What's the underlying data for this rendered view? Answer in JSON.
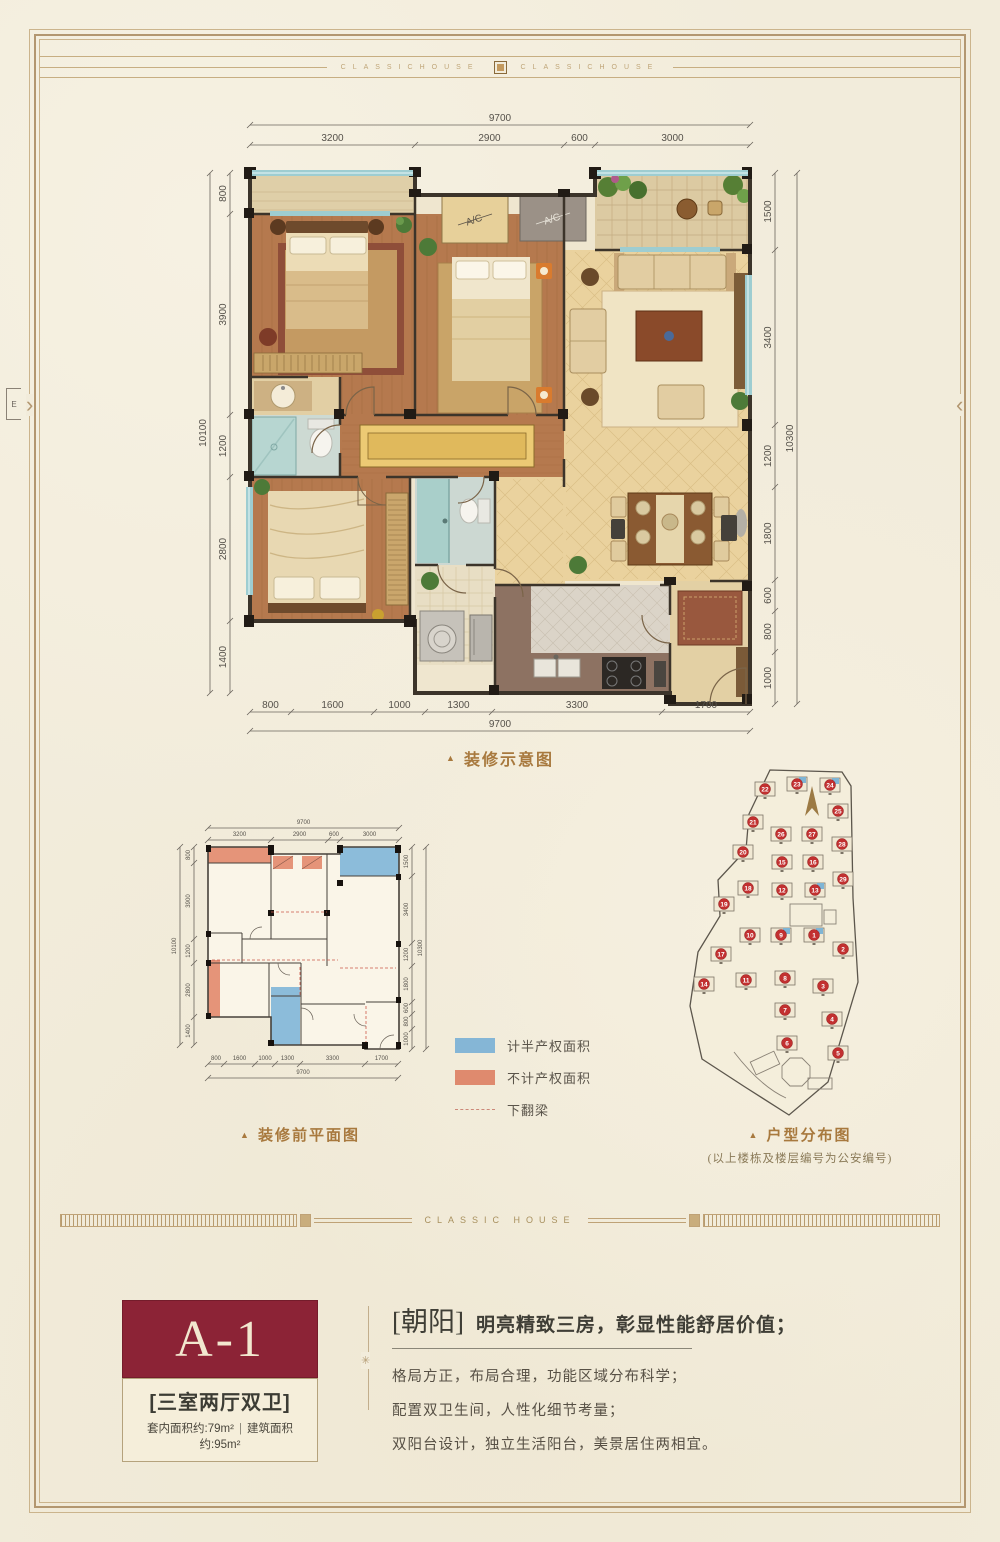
{
  "page": {
    "band_text": "CLASSICHOUSE",
    "divider_text": "CLASSIC HOUSE",
    "chevron_left": "›",
    "chevron_right": "‹",
    "edge_mark": "E",
    "divider_ornament": "✳",
    "colors": {
      "paper": "#f2ecdb",
      "frame_gold": "#b39770",
      "maroon": "#8c2336",
      "caption": "#a8793e"
    }
  },
  "captions": {
    "marker": "▲",
    "main": "装修示意图",
    "small": "装修前平面图",
    "site": "户型分布图",
    "site_note": "(以上楼栋及楼层编号为公安编号)"
  },
  "main_plan": {
    "dims_top_total": "9700",
    "dims_top": [
      "3200",
      "2900",
      "600",
      "3000"
    ],
    "dims_left_total": "10100",
    "dims_left": [
      "800",
      "3900",
      "1200",
      "2800",
      "1400"
    ],
    "dims_right_total": "10300",
    "dims_right": [
      "1500",
      "3400",
      "1200",
      "1800",
      "600",
      "800",
      "1000"
    ],
    "dims_bottom_total": "9700",
    "dims_bottom": [
      "800",
      "1600",
      "1000",
      "1300",
      "3300",
      "1700"
    ],
    "ac_label": "A/C"
  },
  "legend": {
    "items": [
      {
        "label": "计半产权面积",
        "color": "#85b6d6"
      },
      {
        "label": "不计产权面积",
        "color": "#df8a6e"
      },
      {
        "label": "下翻梁",
        "color": "dashed"
      }
    ]
  },
  "site_map": {
    "buildings": [
      {
        "n": "22",
        "x": 75,
        "y": 33
      },
      {
        "n": "23",
        "x": 107,
        "y": 28,
        "hl": true
      },
      {
        "n": "24",
        "x": 140,
        "y": 29,
        "hl": true
      },
      {
        "n": "21",
        "x": 63,
        "y": 66
      },
      {
        "n": "25",
        "x": 148,
        "y": 55
      },
      {
        "n": "26",
        "x": 91,
        "y": 78
      },
      {
        "n": "27",
        "x": 122,
        "y": 78
      },
      {
        "n": "28",
        "x": 152,
        "y": 88
      },
      {
        "n": "20",
        "x": 53,
        "y": 96
      },
      {
        "n": "15",
        "x": 92,
        "y": 106
      },
      {
        "n": "16",
        "x": 123,
        "y": 106
      },
      {
        "n": "29",
        "x": 153,
        "y": 123
      },
      {
        "n": "18",
        "x": 58,
        "y": 132
      },
      {
        "n": "12",
        "x": 92,
        "y": 134
      },
      {
        "n": "13",
        "x": 125,
        "y": 134,
        "hl": true
      },
      {
        "n": "19",
        "x": 34,
        "y": 148
      },
      {
        "n": "17",
        "x": 31,
        "y": 198
      },
      {
        "n": "14",
        "x": 14,
        "y": 228
      },
      {
        "n": "10",
        "x": 60,
        "y": 179
      },
      {
        "n": "9",
        "x": 91,
        "y": 179,
        "hl": true
      },
      {
        "n": "1",
        "x": 124,
        "y": 179,
        "hl": true
      },
      {
        "n": "2",
        "x": 153,
        "y": 193
      },
      {
        "n": "11",
        "x": 56,
        "y": 224
      },
      {
        "n": "8",
        "x": 95,
        "y": 222
      },
      {
        "n": "3",
        "x": 133,
        "y": 230
      },
      {
        "n": "7",
        "x": 95,
        "y": 254
      },
      {
        "n": "4",
        "x": 142,
        "y": 263
      },
      {
        "n": "6",
        "x": 97,
        "y": 287
      },
      {
        "n": "5",
        "x": 148,
        "y": 297
      }
    ]
  },
  "unit": {
    "code": "A-1",
    "type": "[三室两厅双卫]",
    "area_inner": "套内面积约:79m²",
    "area_sep": "|",
    "area_built": "建筑面积约:95m²"
  },
  "intro": {
    "tag": "[朝阳]",
    "headline": "明亮精致三房，彰显性能舒居价值；",
    "lines": [
      "格局方正，布局合理，功能区域分布科学；",
      "配置双卫生间，人性化细节考量；",
      "双阳台设计，独立生活阳台，美景居住两相宜。"
    ]
  }
}
